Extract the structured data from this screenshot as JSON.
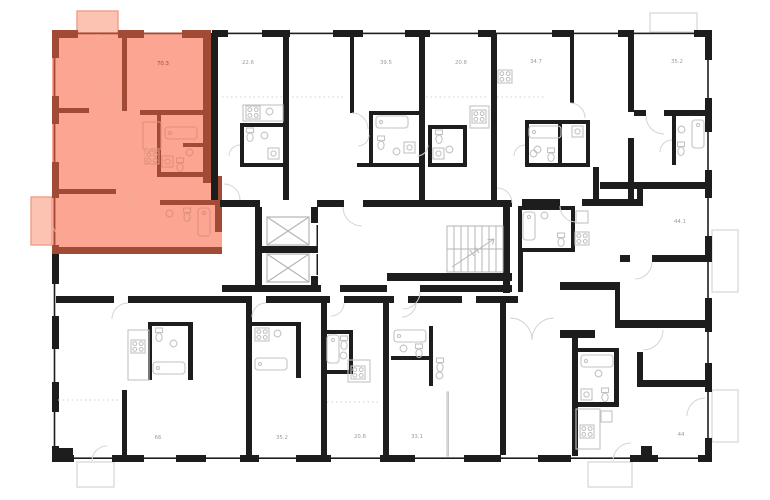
{
  "theme": {
    "background": "#ffffff",
    "wall": "#1d1d1d",
    "hlFill": "#fba592",
    "hlWall": "#a14b36",
    "hlBalconyFill": "#fcc3b3",
    "hlBalconyStroke": "#f29d89",
    "hlFixture": "#e0907c",
    "hlArc": "#eeae9d",
    "hlLabel": "#b8402f",
    "fixture": "#c3c3c3",
    "arc": "#d4d4d4",
    "dotted": "#cfcfcf",
    "shaft": "#b5b5b5",
    "balconyStroke": "#dcdcdc",
    "label": "#9b9b9b"
  },
  "units": [
    {
      "area": "70.3",
      "highlighted": true
    },
    {
      "area": "22.6"
    },
    {
      "area": "39.5"
    },
    {
      "area": "20.8"
    },
    {
      "area": "34.7"
    },
    {
      "area": "35.2"
    },
    {
      "area": "44.1"
    },
    {
      "area": "66"
    },
    {
      "area": "35.2"
    },
    {
      "area": "20.8"
    },
    {
      "area": "33.1"
    },
    {
      "area": "44"
    }
  ]
}
